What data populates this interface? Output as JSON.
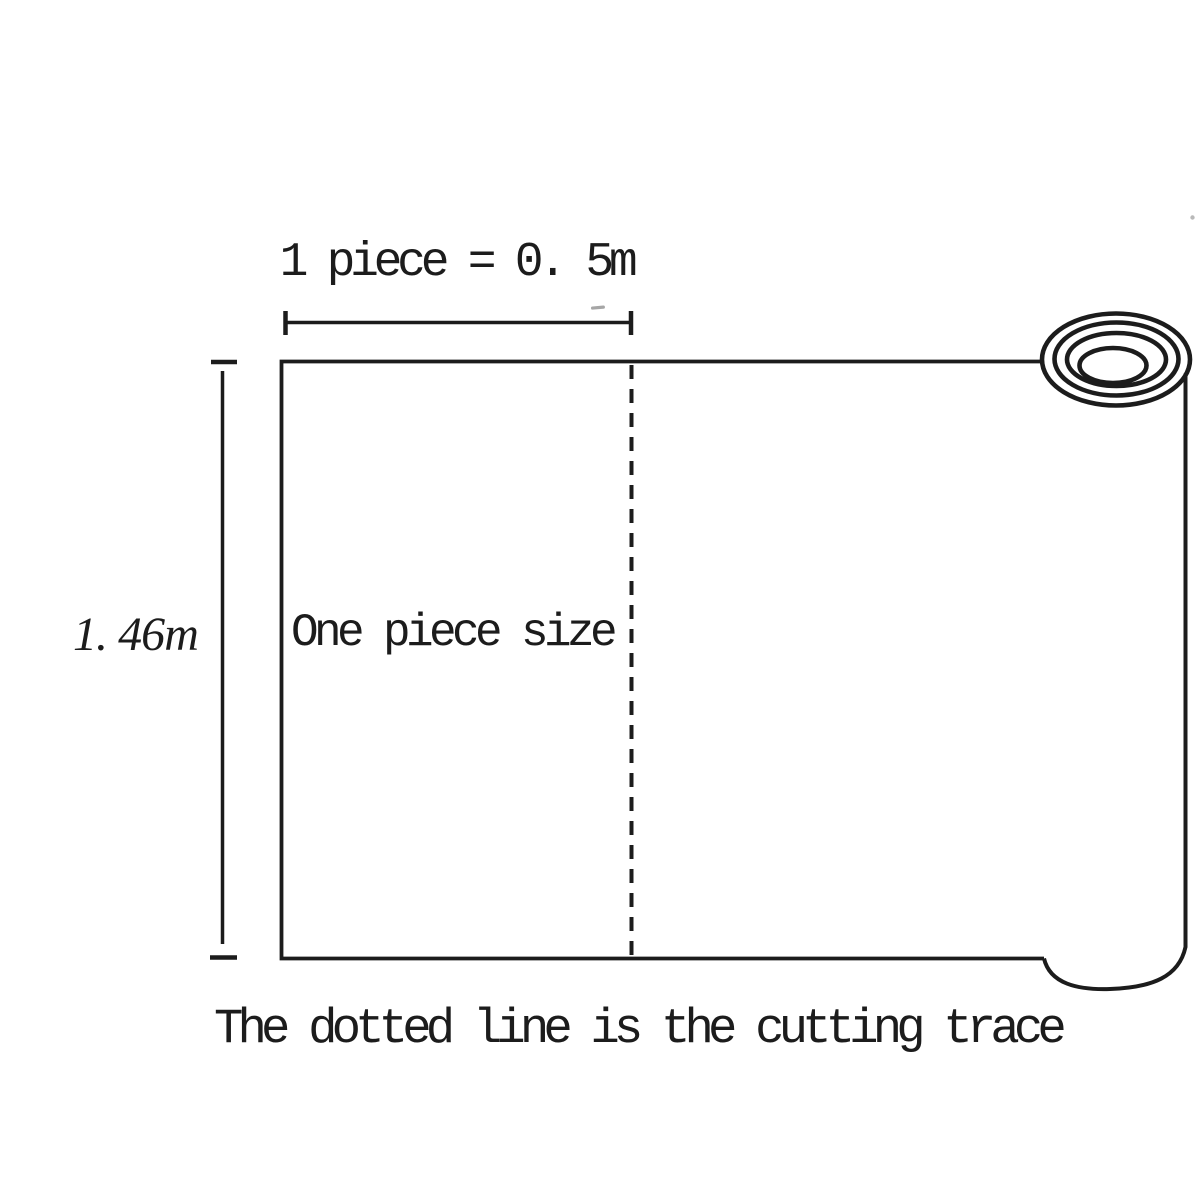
{
  "diagram": {
    "background_color": "#ffffff",
    "ink_color": "#1c1c1c",
    "labels": {
      "width_dimension": "1 piece = 0. 5m",
      "height_dimension": "1. 46m",
      "piece_area": "One piece size",
      "caption": "The dotted line is the cutting trace"
    },
    "elements": {
      "cutting_line_style": "dashed",
      "roll_rings": 4
    }
  }
}
